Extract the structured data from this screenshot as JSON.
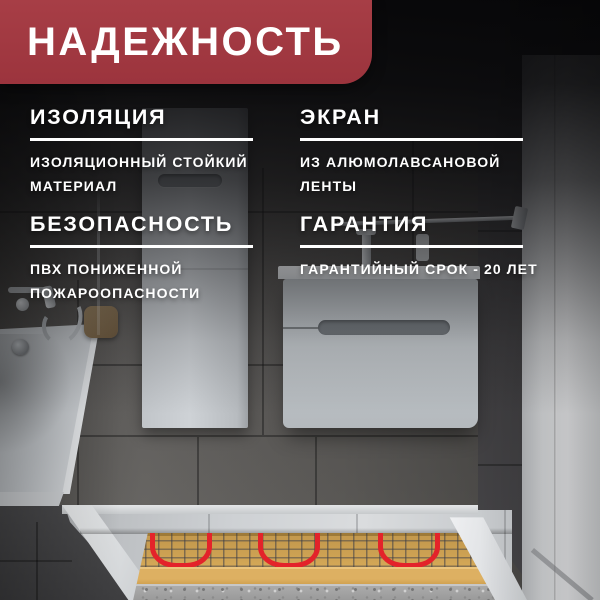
{
  "banner": {
    "title": "НАДЕЖНОСТЬ"
  },
  "features": [
    {
      "heading": "ИЗОЛЯЦИЯ",
      "body": "ИЗОЛЯЦИОННЫЙ СТОЙКИЙ МАТЕРИАЛ"
    },
    {
      "heading": "ЭКРАН",
      "body": "ИЗ АЛЮМОЛАВСАНОВОЙ ЛЕНТЫ"
    },
    {
      "heading": "БЕЗОПАСНОСТЬ",
      "body": "ПВХ ПОНИЖЕННОЙ ПОЖАРООПАСНОСТИ"
    },
    {
      "heading": "ГАРАНТИЯ",
      "body": "ГАРАНТИЙНЫЙ СРОК - 20 ЛЕТ"
    }
  ],
  "colors": {
    "accent_red": "#a13a42",
    "cable_red": "#e3232a",
    "mat_sand": "#d4a857",
    "concrete_grey": "#9a9a9a"
  }
}
